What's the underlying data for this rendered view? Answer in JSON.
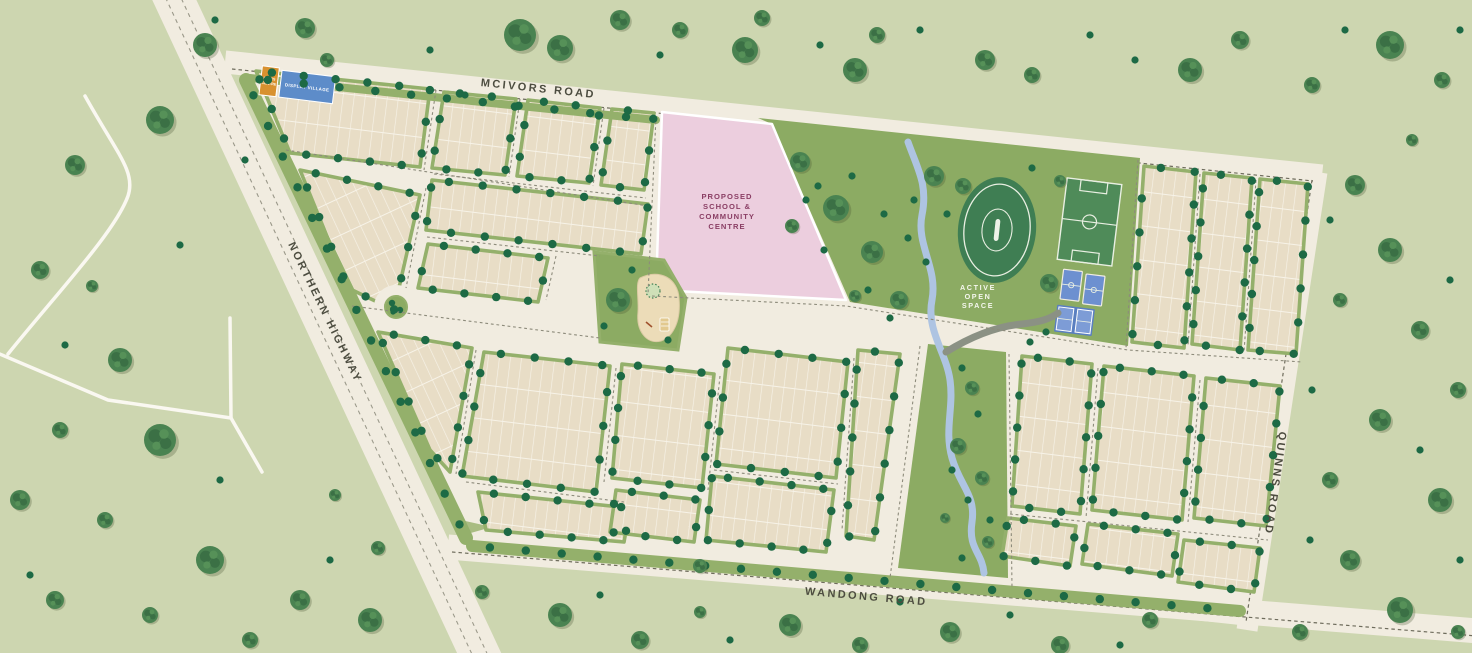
{
  "title": "Residential estate masterplan map",
  "roads": {
    "mcivors": "MCIVORS ROAD",
    "northern_highway": "NORTHERN HIGHWAY",
    "wandong": "WANDONG ROAD",
    "quinns": "QUINNS ROAD"
  },
  "places": {
    "school": {
      "l1": "PROPOSED",
      "l2": "SCHOOL &",
      "l3": "COMMUNITY",
      "l4": "CENTRE"
    },
    "open_space": {
      "l1": "ACTIVE",
      "l2": "OPEN",
      "l3": "SPACE"
    },
    "sales_centre": {
      "l1": "SALES",
      "l2": "CENTRE"
    },
    "display_village": "DISPLAY VILLAGE"
  },
  "colors": {
    "background": "#cdd6b0",
    "road": "#f1ece0",
    "block_beige": "#e8ddc6",
    "verge_green": "#94b06b",
    "street_tree": "#1d6a45",
    "open_space_green": "#8cab63",
    "oval_green": "#3f7e53",
    "school_pink": "#eccede",
    "school_text": "#8a3e64",
    "creek_blue": "#aec4e2",
    "court_blue": "#6d90d0",
    "sales_orange": "#d8912f",
    "display_blue": "#5d8cc9"
  }
}
